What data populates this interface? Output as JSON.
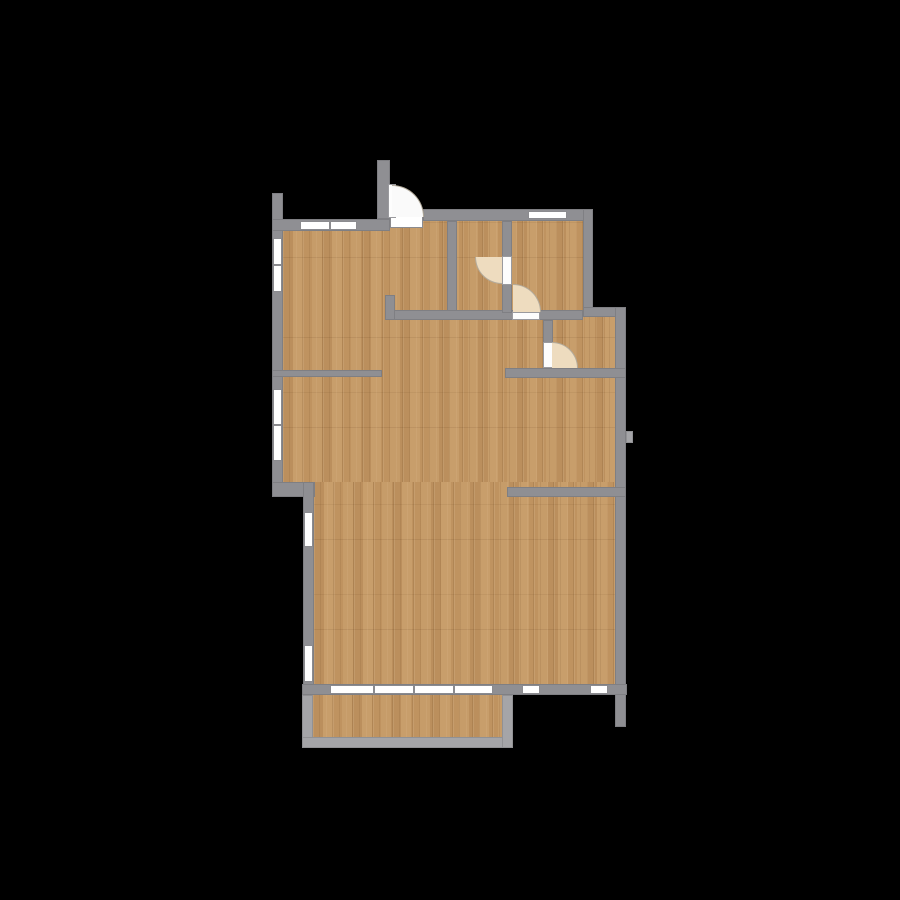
{
  "scene": {
    "type": "apartment-floor-plan-top-view",
    "canvas": {
      "width": 900,
      "height": 900
    }
  },
  "palette": {
    "background": "#000000",
    "wall": "#8f8f93",
    "balcony_wall": "#a5a5a8",
    "floor": "#c39764",
    "window_fill": "#ffffff",
    "window_frame": "#8b8b8f",
    "door_leaf": "#fdfdfd",
    "door_swing_interior": "#eedcbf",
    "door_swing_entry": "#fafafa",
    "swing_line": "#b3ab9c"
  },
  "floors": [
    {
      "name": "upper-rooms-floor",
      "x": 283,
      "y": 221,
      "w": 300,
      "h": 91
    },
    {
      "name": "living-area-floor",
      "x": 283,
      "y": 312,
      "w": 332,
      "h": 170
    },
    {
      "name": "lower-living-floor",
      "x": 314,
      "y": 482,
      "w": 301,
      "h": 202
    },
    {
      "name": "balcony-floor",
      "x": 313,
      "y": 695,
      "w": 189,
      "h": 42
    }
  ],
  "walls": [
    {
      "name": "left-wall-upper",
      "type": "exterior",
      "x": 272,
      "y": 193,
      "w": 11,
      "h": 304
    },
    {
      "name": "left-step-wall",
      "type": "exterior",
      "x": 272,
      "y": 482,
      "w": 43,
      "h": 15
    },
    {
      "name": "left-wall-lower",
      "type": "exterior",
      "x": 303,
      "y": 482,
      "w": 11,
      "h": 213
    },
    {
      "name": "top-wall-left",
      "type": "exterior",
      "x": 272,
      "y": 219,
      "w": 118,
      "h": 12
    },
    {
      "name": "entry-door-stub-wall",
      "type": "exterior",
      "x": 377,
      "y": 160,
      "w": 13,
      "h": 59
    },
    {
      "name": "top-wall-right",
      "type": "exterior",
      "x": 423,
      "y": 209,
      "w": 170,
      "h": 12
    },
    {
      "name": "topright-room-right-wall",
      "type": "exterior",
      "x": 583,
      "y": 209,
      "w": 10,
      "h": 108
    },
    {
      "name": "right-step-wall",
      "type": "exterior",
      "x": 583,
      "y": 307,
      "w": 43,
      "h": 10
    },
    {
      "name": "right-wall-main",
      "type": "exterior",
      "x": 615,
      "y": 307,
      "w": 11,
      "h": 420
    },
    {
      "name": "right-wall-notch",
      "type": "balcony",
      "x": 626,
      "y": 431,
      "w": 7,
      "h": 12
    },
    {
      "name": "bottom-wall",
      "type": "exterior",
      "x": 302,
      "y": 684,
      "w": 325,
      "h": 11
    },
    {
      "name": "hall-right-wall",
      "type": "interior",
      "x": 447,
      "y": 221,
      "w": 10,
      "h": 97
    },
    {
      "name": "hall-bottom-wall",
      "type": "interior",
      "x": 385,
      "y": 310,
      "w": 198,
      "h": 10
    },
    {
      "name": "hall-corner-stub",
      "type": "interior",
      "x": 385,
      "y": 295,
      "w": 10,
      "h": 25
    },
    {
      "name": "midroom-right-wall",
      "type": "interior",
      "x": 502,
      "y": 221,
      "w": 10,
      "h": 92
    },
    {
      "name": "wc-left-wall",
      "type": "interior",
      "x": 543,
      "y": 320,
      "w": 10,
      "h": 48
    },
    {
      "name": "wc-bottom-wall",
      "type": "interior",
      "x": 505,
      "y": 368,
      "w": 121,
      "h": 10
    },
    {
      "name": "right-room-divider-wall",
      "type": "interior",
      "x": 507,
      "y": 487,
      "w": 119,
      "h": 10
    },
    {
      "name": "leftroom-bottom-wall",
      "type": "interior",
      "x": 272,
      "y": 370,
      "w": 110,
      "h": 7
    },
    {
      "name": "balcony-left-wall",
      "type": "balcony",
      "x": 302,
      "y": 695,
      "w": 11,
      "h": 53
    },
    {
      "name": "balcony-bottom-wall",
      "type": "balcony",
      "x": 302,
      "y": 737,
      "w": 211,
      "h": 11
    },
    {
      "name": "balcony-right-wall",
      "type": "balcony",
      "x": 502,
      "y": 695,
      "w": 11,
      "h": 53
    }
  ],
  "windows": [
    {
      "name": "top-left-window",
      "orient": "h",
      "x": 300,
      "y": 221,
      "w": 57,
      "h": 9,
      "mullions": [
        328
      ]
    },
    {
      "name": "top-right-window",
      "orient": "h",
      "x": 528,
      "y": 211,
      "w": 39,
      "h": 8,
      "mullions": []
    },
    {
      "name": "left-upper-window-1",
      "orient": "v",
      "x": 273,
      "y": 238,
      "w": 9,
      "h": 54,
      "mullions": [
        263
      ]
    },
    {
      "name": "left-upper-window-2",
      "orient": "v",
      "x": 273,
      "y": 389,
      "w": 9,
      "h": 72,
      "mullions": [
        423
      ]
    },
    {
      "name": "left-lower-window-1",
      "orient": "v",
      "x": 304,
      "y": 512,
      "w": 9,
      "h": 35,
      "mullions": []
    },
    {
      "name": "left-lower-window-2",
      "orient": "v",
      "x": 304,
      "y": 645,
      "w": 9,
      "h": 37,
      "mullions": []
    },
    {
      "name": "balcony-slider-window",
      "orient": "h",
      "x": 330,
      "y": 685,
      "w": 163,
      "h": 9,
      "mullions": [
        372,
        412,
        452
      ]
    },
    {
      "name": "bottom-window-mid",
      "orient": "h",
      "x": 522,
      "y": 685,
      "w": 18,
      "h": 9,
      "mullions": []
    },
    {
      "name": "bottom-window-right",
      "orient": "h",
      "x": 590,
      "y": 685,
      "w": 18,
      "h": 9,
      "mullions": []
    },
    {
      "name": "entry-door-threshold",
      "orient": "h",
      "x": 390,
      "y": 210,
      "w": 33,
      "h": 18,
      "mullions": []
    }
  ],
  "doors": [
    {
      "name": "entry-door",
      "leaf": {
        "x": 388,
        "y": 184,
        "w": 8,
        "h": 34
      },
      "swing": {
        "x": 392,
        "y": 185,
        "size": 32,
        "corner": "tr",
        "fill_key": "door_swing_entry"
      }
    },
    {
      "name": "midroom-door",
      "leaf": {
        "x": 502,
        "y": 256,
        "w": 10,
        "h": 29
      },
      "swing": {
        "x": 475,
        "y": 257,
        "size": 27,
        "corner": "bl",
        "fill_key": "door_swing_interior"
      }
    },
    {
      "name": "topright-room-door",
      "leaf": {
        "x": 512,
        "y": 312,
        "w": 28,
        "h": 8
      },
      "swing": {
        "x": 513,
        "y": 284,
        "size": 28,
        "corner": "tr",
        "fill_key": "door_swing_interior"
      }
    },
    {
      "name": "wc-door",
      "leaf": {
        "x": 543,
        "y": 342,
        "w": 10,
        "h": 26
      },
      "swing": {
        "x": 552,
        "y": 342,
        "size": 26,
        "corner": "tr",
        "fill_key": "door_swing_interior"
      }
    }
  ]
}
